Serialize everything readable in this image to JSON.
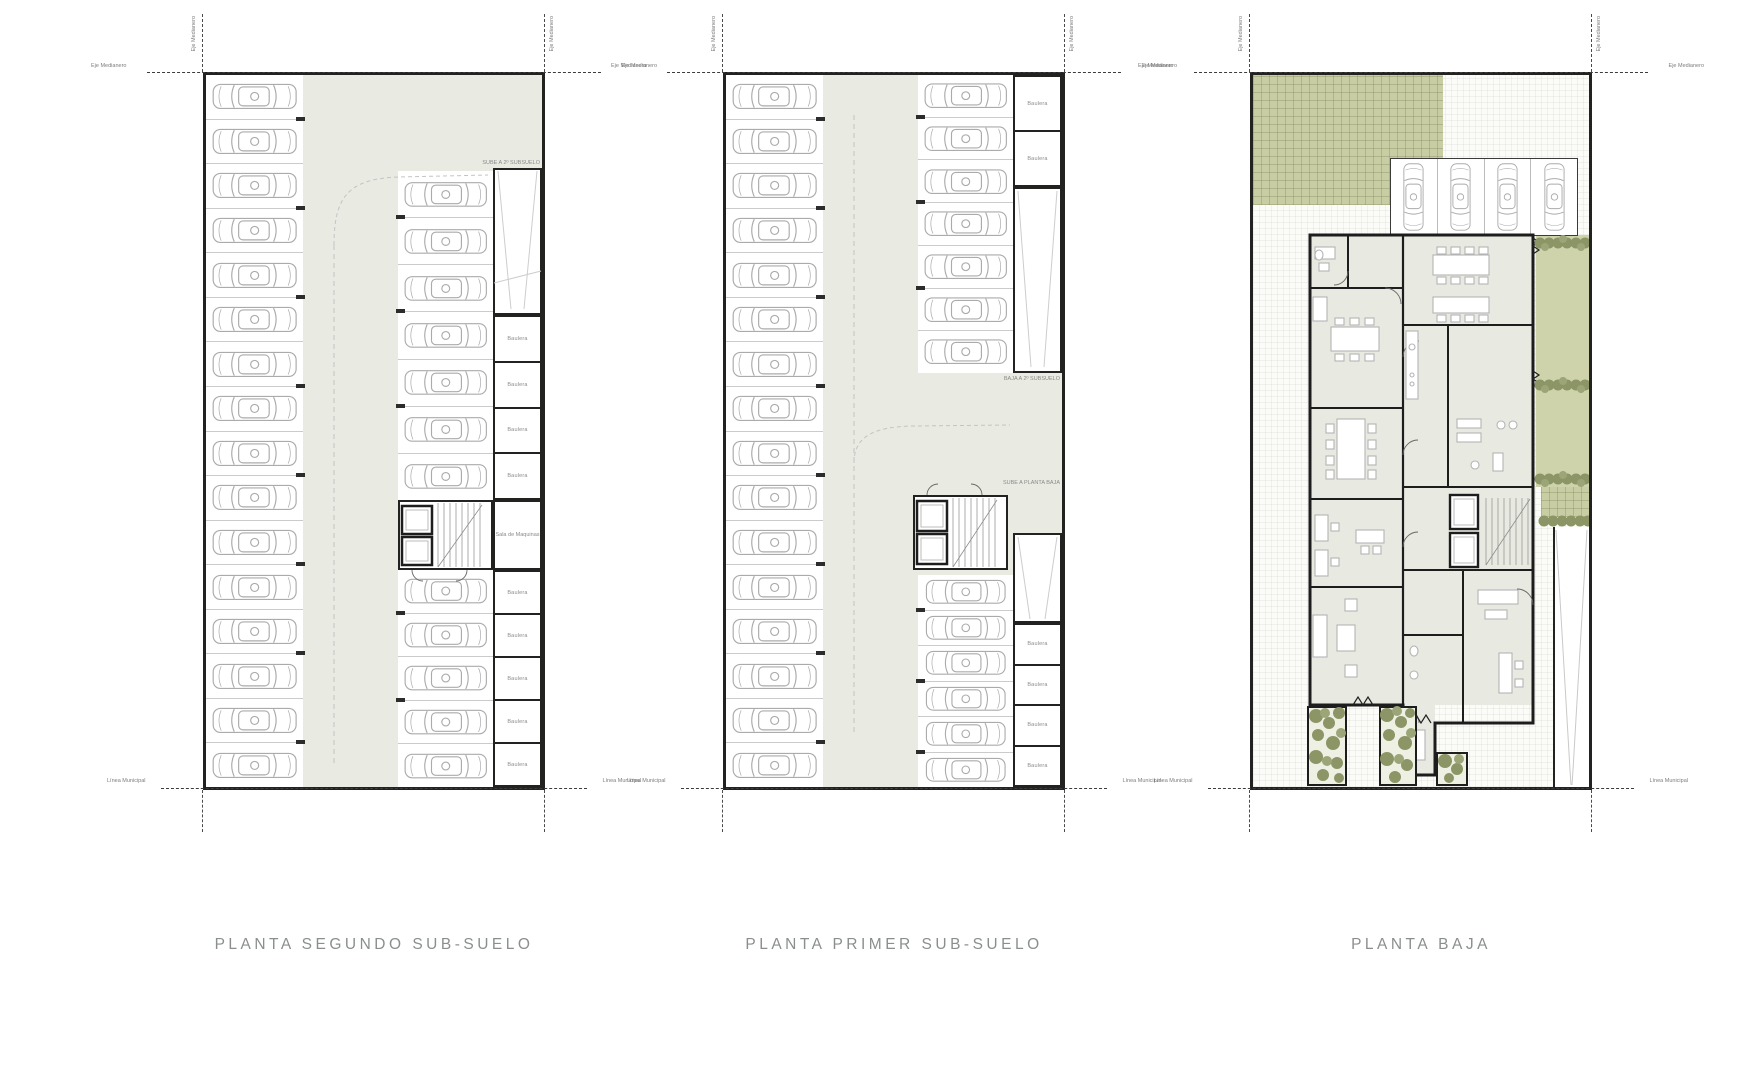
{
  "sheet": {
    "background": "#ffffff"
  },
  "colors": {
    "wall": "#222221",
    "drive_floor": "#e9eae2",
    "room_floor": "#e8e9e1",
    "green_pavers": "#c9cda4",
    "garden": "#cfd3ab",
    "bush_dark": "#8b9565",
    "bush_light": "#9ba577",
    "car_stroke": "#ababab",
    "stall_divider": "#cbcbcb",
    "dash_guide": "#c4c4c4",
    "title_text": "#8a8f8d",
    "annotation_text": "#7d7d7d"
  },
  "annotations": {
    "property_axis": "Eje Medianero",
    "municipal_line": "Línea Municipal"
  },
  "plans": [
    {
      "title": "PLANTA SEGUNDO SUB-SUELO",
      "labels": {
        "ramp": "SUBE A 2º SUBSUELO",
        "machine_room": "Sala de Maquinas",
        "storage": "Baulera"
      },
      "stalls": {
        "left": {
          "count": 16
        },
        "right_top": {
          "count": 7
        },
        "right_bottom": {
          "count": 5
        }
      },
      "storage_rooms": {
        "top": {
          "count": 4,
          "label": "plans.0.labels.storage"
        },
        "bottom": {
          "count": 5,
          "label": "plans.0.labels.storage"
        }
      }
    },
    {
      "title": "PLANTA PRIMER SUB-SUELO",
      "labels": {
        "ramp_down": "BAJA A 2º SUBSUELO",
        "ramp_up": "SUBE A PLANTA BAJA",
        "storage": "Baulera"
      },
      "stalls": {
        "left": {
          "count": 16
        },
        "right_top": {
          "count": 7
        },
        "right_bottom": {
          "count": 6
        }
      },
      "storage_rooms": {
        "top": {
          "count": 2,
          "label": "plans.1.labels.storage"
        },
        "bottom": {
          "count": 4,
          "label": "plans.1.labels.storage"
        }
      }
    },
    {
      "title": "PLANTA BAJA",
      "stalls": {
        "top": {
          "count": 4
        }
      }
    }
  ]
}
